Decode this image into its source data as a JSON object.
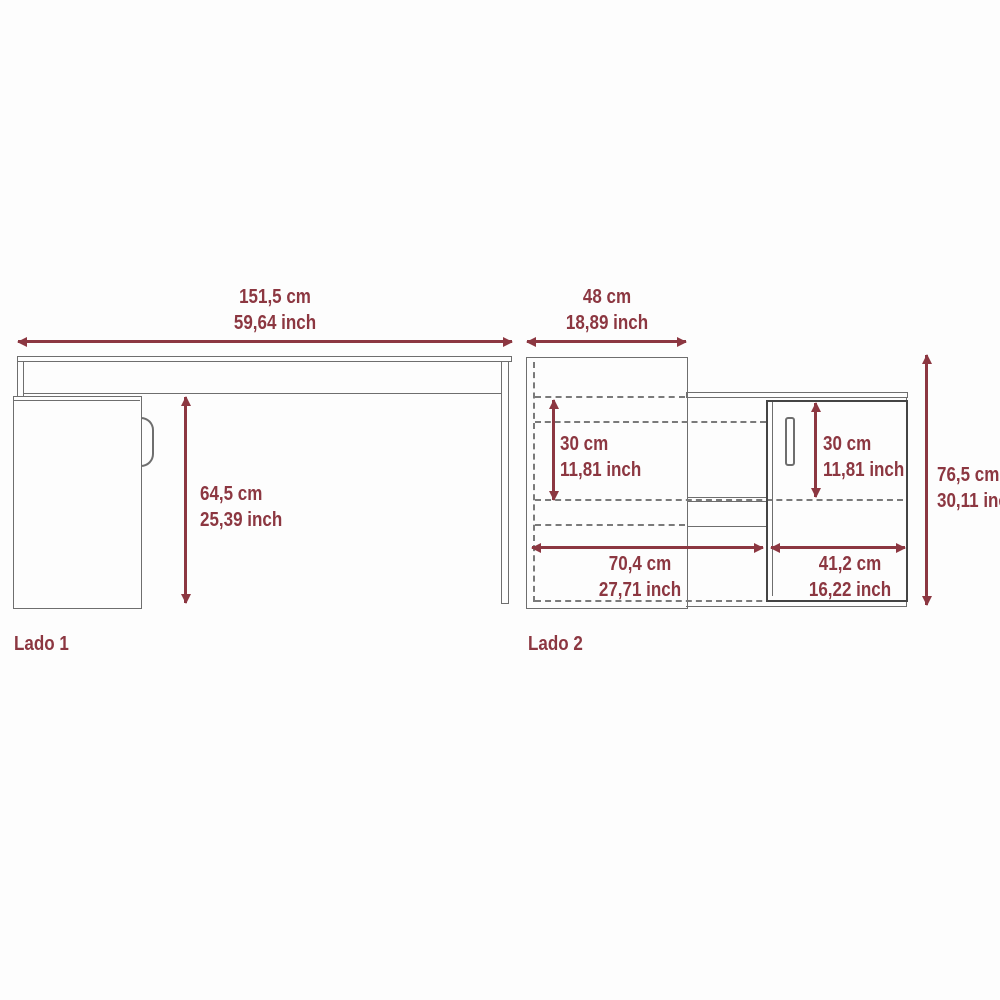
{
  "colors": {
    "dimension": "#8c3741",
    "line": "#6e6e6e",
    "door_line": "#444444",
    "background": "#fdfdfd"
  },
  "lado1": {
    "label": "Lado 1",
    "width_cm": "151,5 cm",
    "width_inch": "59,64 inch",
    "height_cm": "64,5 cm",
    "height_inch": "25,39 inch"
  },
  "lado2": {
    "label": "Lado 2",
    "top_width_cm": "48 cm",
    "top_width_inch": "18,89 inch",
    "shelf_height_cm": "30 cm",
    "shelf_height_inch": "11,81 inch",
    "door_height_cm": "30 cm",
    "door_height_inch": "11,81 inch",
    "total_height_cm": "76,5 cm",
    "total_height_inch": "30,11 inch",
    "bottom_left_width_cm": "70,4 cm",
    "bottom_left_width_inch": "27,71 inch",
    "bottom_right_width_cm": "41,2 cm",
    "bottom_right_width_inch": "16,22 inch"
  }
}
